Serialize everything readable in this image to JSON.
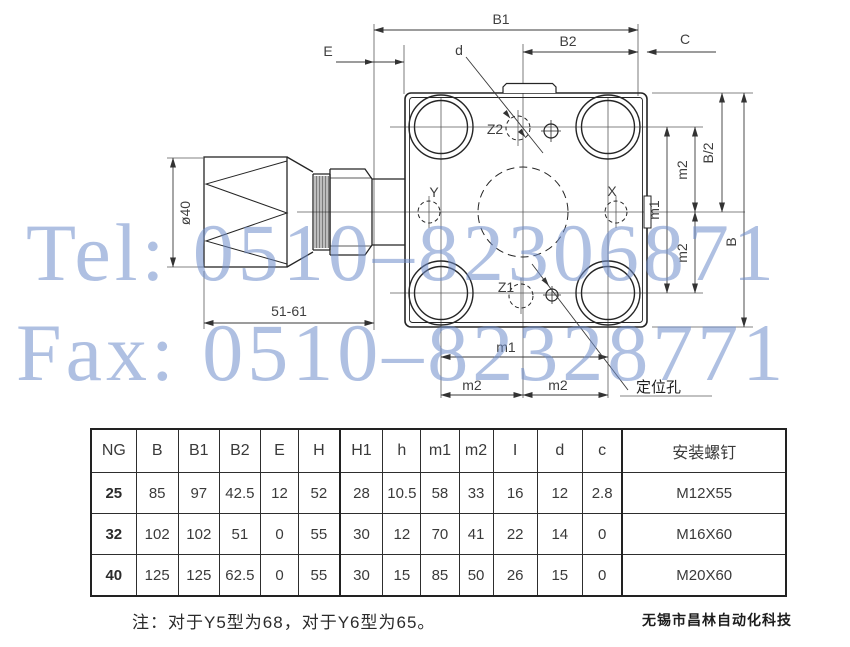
{
  "watermark": {
    "tel": "Tel: 0510–82306871",
    "fax": "Fax: 0510–82328771",
    "color_hex": "#7e9ed6"
  },
  "drawing": {
    "dims": {
      "b1": "B1",
      "b2": "B2",
      "c": "C",
      "e": "E",
      "d": "d",
      "dia": "ø40",
      "range": "51-61",
      "m1": "m1",
      "m2": "m2",
      "b_half": "B/2",
      "b": "B"
    },
    "ports": {
      "z1": "Z1",
      "z2": "Z2",
      "x": "X",
      "y": "Y"
    },
    "callouts": {
      "locating_hole": "定位孔"
    }
  },
  "table": {
    "headers": [
      "NG",
      "B",
      "B1",
      "B2",
      "E",
      "H",
      "H1",
      "h",
      "m1",
      "m2",
      "I",
      "d",
      "c",
      "安装螺钉"
    ],
    "rows": [
      [
        "25",
        "85",
        "97",
        "42.5",
        "12",
        "52",
        "28",
        "10.5",
        "58",
        "33",
        "16",
        "12",
        "2.8",
        "M12X55"
      ],
      [
        "32",
        "102",
        "102",
        "51",
        "0",
        "55",
        "30",
        "12",
        "70",
        "41",
        "22",
        "14",
        "0",
        "M16X60"
      ],
      [
        "40",
        "125",
        "125",
        "62.5",
        "0",
        "55",
        "30",
        "15",
        "85",
        "50",
        "26",
        "15",
        "0",
        "M20X60"
      ]
    ]
  },
  "footer": {
    "note": "注：对于Y5型为68，对于Y6型为65。",
    "company": "无锡市昌林自动化科技"
  }
}
